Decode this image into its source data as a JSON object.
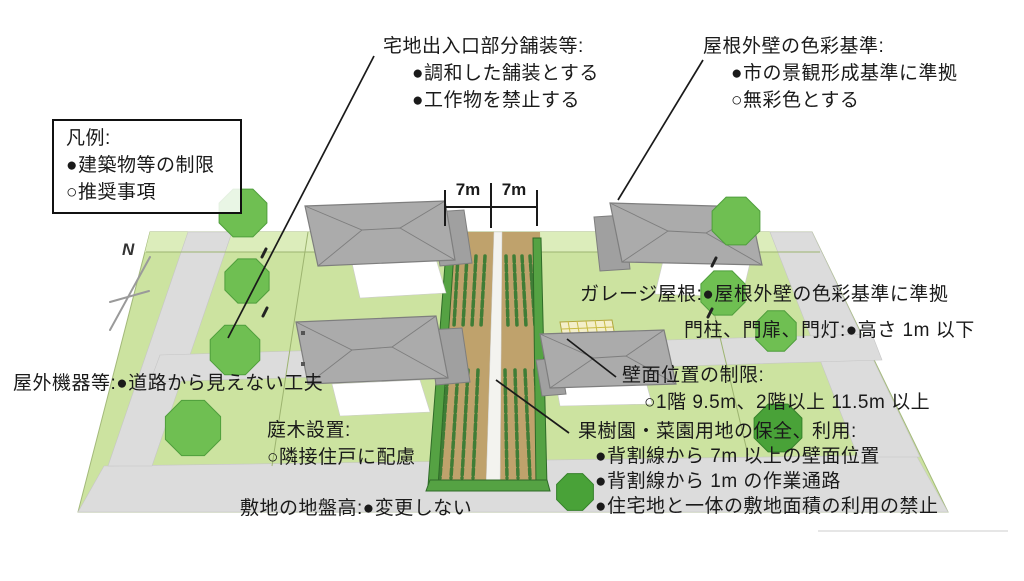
{
  "legend": {
    "title": "凡例:",
    "items": [
      "●建築物等の制限",
      "○推奨事項"
    ]
  },
  "annotations": {
    "entrance_paving": {
      "title": "宅地出入口部分舗装等:",
      "items": [
        "●調和した舗装とする",
        "●工作物を禁止する"
      ]
    },
    "roof_wall_color": {
      "title": "屋根外壁の色彩基準:",
      "items": [
        "●市の景観形成基準に準拠",
        "○無彩色とする"
      ]
    },
    "garage_roof": {
      "text": "ガレージ屋根:●屋根外壁の色彩基準に準拠"
    },
    "gate": {
      "text": "門柱、門扉、門灯:●高さ 1m 以下"
    },
    "wall_position": {
      "title": "壁面位置の制限:",
      "items": [
        "○1階 9.5m、2階以上 11.5m 以上"
      ]
    },
    "outdoor_equipment": {
      "text": "屋外機器等:●道路から見えない工夫"
    },
    "garden_trees": {
      "title": "庭木設置:",
      "items": [
        "○隣接住戸に配慮"
      ]
    },
    "ground_level": {
      "text": "敷地の地盤高:●変更しない"
    },
    "orchard": {
      "title": "果樹園・菜園用地の保全、利用:",
      "items": [
        "●背割線から 7m 以上の壁面位置",
        "●背割線から 1m の作業通路",
        "●住宅地と一体の敷地面積の利用の禁止"
      ]
    }
  },
  "dimensions": {
    "left": "7m",
    "right": "7m"
  },
  "compass": {
    "label": "N"
  },
  "colors": {
    "plot": "#cce3a0",
    "plot-light": "#dcedbb",
    "road": "#dcdcdc",
    "soil": "#bfa26c",
    "path": "#f3f3ef",
    "crop": "#3f7d36",
    "hedge": "#55a243",
    "hedge-dark": "#2f6b28",
    "roof": "#ababab",
    "roof-wing": "#a0a0a0",
    "roof-edge": "#7e7e7e",
    "wall": "#ffffff",
    "tree": "#6fbf52",
    "tree-edge": "#4f9e3c",
    "tree-dark": "#49a238",
    "site-edge": "#a3b97a",
    "text": "#1a1a1a",
    "line": "#1a1a1a",
    "compass": "#9a9a9a"
  }
}
